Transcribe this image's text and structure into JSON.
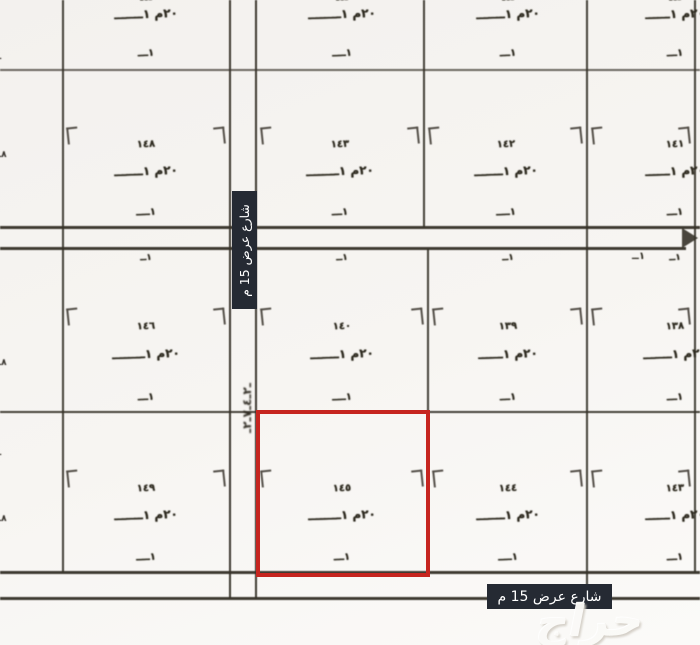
{
  "streets": {
    "vertical_street_label": "شارع عرض 15 م",
    "bottom_street_label": "شارع عرض 15 م",
    "street_scribble": "ـ٢ـ٤ـ٧ـ٢ـ",
    "street_end_mark": "١ــ"
  },
  "watermark": "حراج",
  "colors": {
    "highlight_red": "#c6251f",
    "label_bg": "#252a33",
    "ink": "#38342e"
  },
  "edge_notes": [
    "ــ",
    "٨ــ",
    "٨ــ",
    "ــ",
    "٨ــ"
  ],
  "plots": [
    {
      "number": "",
      "peek": "ـ٤ـ",
      "dim": "٢٠م ١ـــــــ",
      "base": "١ـــ"
    },
    {
      "number": "",
      "peek": "ـ٤ـ",
      "dim": "٢٠م ١ــــــــ",
      "base": "١ــــ"
    },
    {
      "number": "",
      "peek": "ـ٤ـ",
      "dim": "٢٠م ١ـــــــ",
      "base": "١ـــ"
    },
    {
      "number": "",
      "peek": "ـ٤ـ",
      "dim": "٢٠م ١ــــــ",
      "base": "١ـــ"
    },
    {
      "number": "١٤٨",
      "dim": "٢٠م ١ـــــــ",
      "base": "١ــــ"
    },
    {
      "number": "١٤٣",
      "dim": "٢٠م ١ــــــــ",
      "base": "١ـــ"
    },
    {
      "number": "١٤٢",
      "dim": "٢٠م ١ـــــــ",
      "base": "١ــــ"
    },
    {
      "number": "١٤١",
      "dim": "٢٠م ١ــــــ",
      "base": "١ـــ"
    },
    {
      "number": "١٤٦",
      "top": "١ــ",
      "dim": "٢٠م ١ــــــــ",
      "base": "١ـــ"
    },
    {
      "number": "١٤٠",
      "top": "١ــ",
      "dim": "٢٠م ١ـــــــ",
      "base": "١ــــ"
    },
    {
      "number": "١٣٩",
      "top": "١ــ",
      "dim": "٢٠م ١ــــــ",
      "base": "١ـــ"
    },
    {
      "number": "١٣٨",
      "top": "١ــ",
      "dim": "٢٠م ١ـــــــ",
      "base": "١ـــ"
    },
    {
      "number": "١٤٩",
      "dim": "٢٠م ١ـــــــ",
      "base": "١ــــ"
    },
    {
      "number": "١٤٥",
      "dim": "٢٠م ١ــــــــ",
      "base": "١ـــ"
    },
    {
      "number": "١٤٤",
      "dim": "٢٠م ١ـــــــ",
      "base": "١ــــ"
    },
    {
      "number": "١٤٣",
      "dim": "٢٠م ١ــــــ",
      "base": "١ـــ"
    }
  ]
}
